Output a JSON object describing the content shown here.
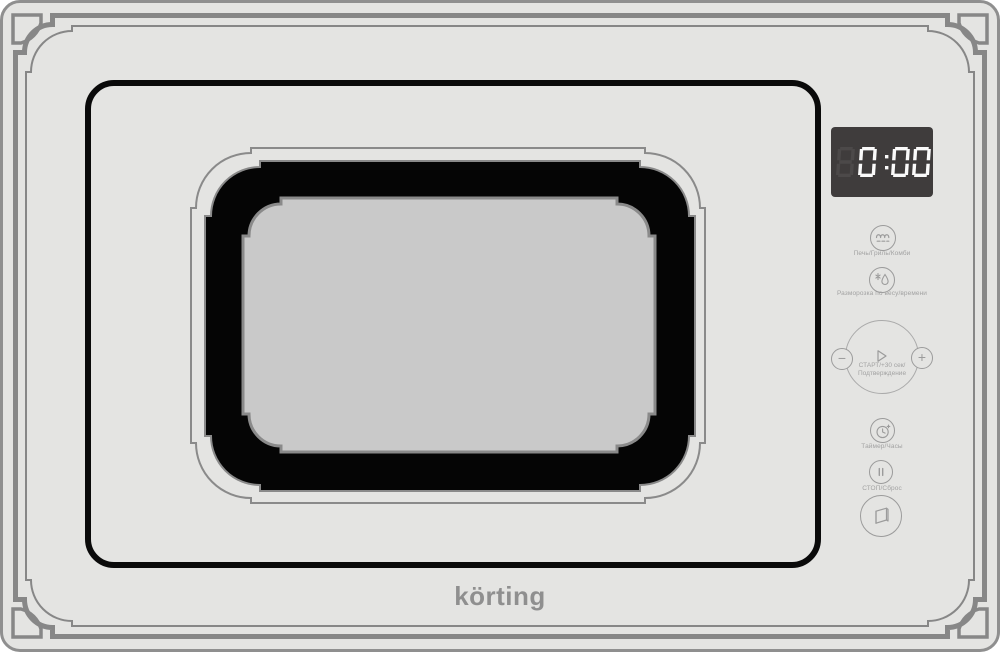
{
  "brand": "körting",
  "display": {
    "time": "0:00",
    "ghost_digit": "8"
  },
  "controls": {
    "mode": {
      "label": "Печь/Гриль/Комби",
      "icon": "microwave-grill-combi-icon"
    },
    "defrost": {
      "label": "Разморозка по весу/времени",
      "icon": "defrost-weight-time-icon"
    },
    "dial": {
      "minus_label": "−",
      "plus_label": "+",
      "start_label_line1": "СТАРТ/+30 сек/",
      "start_label_line2": "Подтверждение",
      "icon": "play-icon"
    },
    "timer": {
      "label": "Таймер/Часы",
      "icon": "timer-clock-icon"
    },
    "stop": {
      "label": "СТОП/Сброс",
      "icon": "pause-icon"
    },
    "door_open": {
      "icon": "door-open-icon"
    }
  },
  "colors": {
    "panel": "#e4e4e2",
    "ornament_gray": "#878787",
    "door_outline": "#0a0a0a",
    "window_band": "#050505",
    "window_glass": "#c9c9c9",
    "display_bg": "#3f3c3c",
    "display_digits": "#fafafa",
    "display_ghost": "#4c4949",
    "control_gray": "#9b9b9b",
    "logo_gray": "#8f8f8f"
  }
}
